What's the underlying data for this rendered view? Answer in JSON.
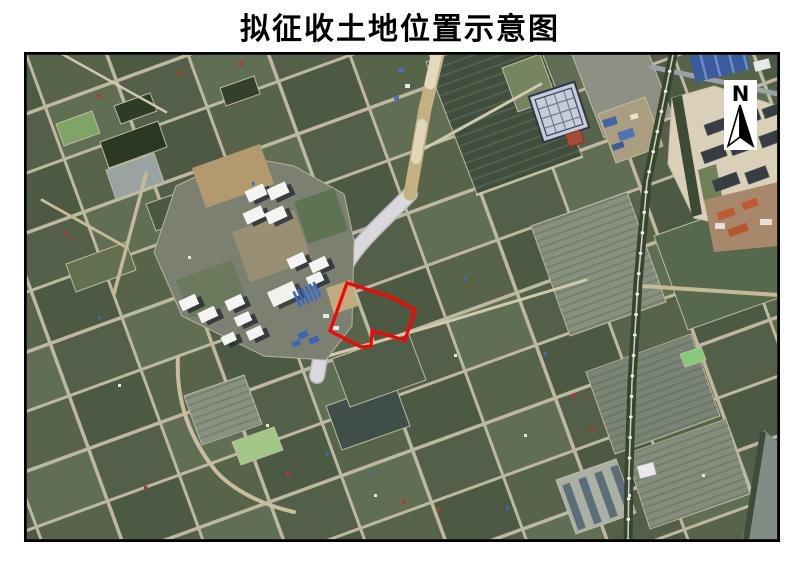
{
  "title": "拟征收土地位置示意图",
  "compass": {
    "label": "N"
  },
  "annotation": {
    "polygon_points": "321,229 365,243 389,256 379,286 346,277 345,292 335,293 304,277",
    "color": "#ff0000",
    "stroke_width": "3.2"
  }
}
